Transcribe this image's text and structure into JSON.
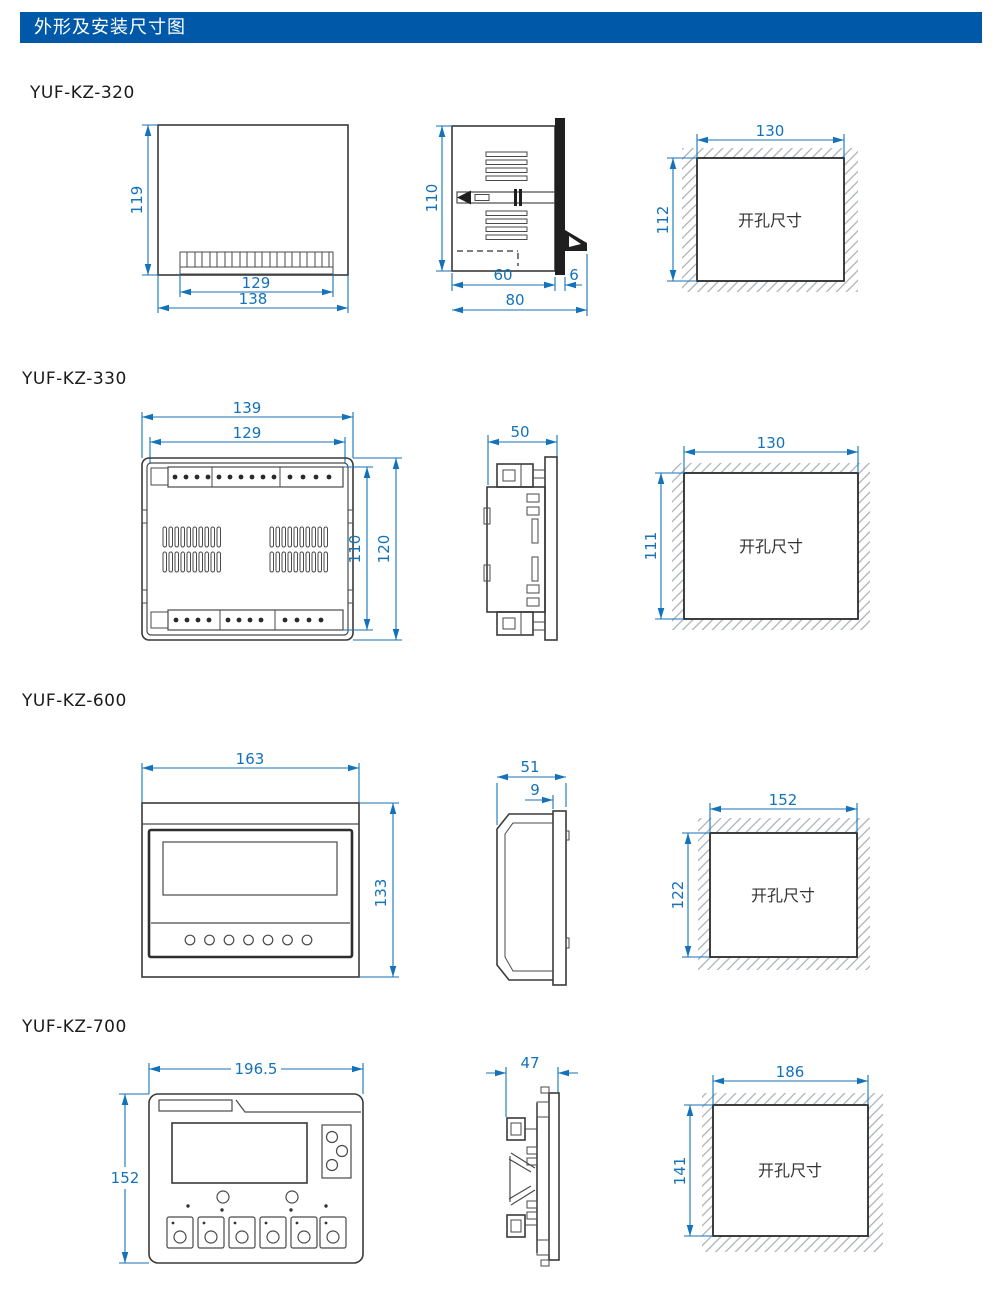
{
  "header": {
    "title": "外形及安装尺寸图"
  },
  "sections": [
    {
      "model": "YUF-KZ-320",
      "front": {
        "height": "119",
        "inner_width": "129",
        "width": "138"
      },
      "side": {
        "height": "110",
        "depth": "60",
        "panel": "6",
        "total_depth": "80"
      },
      "cutout": {
        "width": "130",
        "height": "112",
        "label": "开孔尺寸"
      }
    },
    {
      "model": "YUF-KZ-330",
      "front": {
        "width": "139",
        "inner_width": "129",
        "inner_height": "110",
        "height": "120"
      },
      "side": {
        "depth": "50"
      },
      "cutout": {
        "width": "130",
        "height": "111",
        "label": "开孔尺寸"
      }
    },
    {
      "model": "YUF-KZ-600",
      "front": {
        "width": "163",
        "height": "133"
      },
      "side": {
        "depth": "51",
        "bezel": "9"
      },
      "cutout": {
        "width": "152",
        "height": "122",
        "label": "开孔尺寸"
      }
    },
    {
      "model": "YUF-KZ-700",
      "front": {
        "width": "196.5",
        "height": "152"
      },
      "side": {
        "depth": "47"
      },
      "cutout": {
        "width": "186",
        "height": "141",
        "label": "开孔尺寸"
      }
    }
  ]
}
